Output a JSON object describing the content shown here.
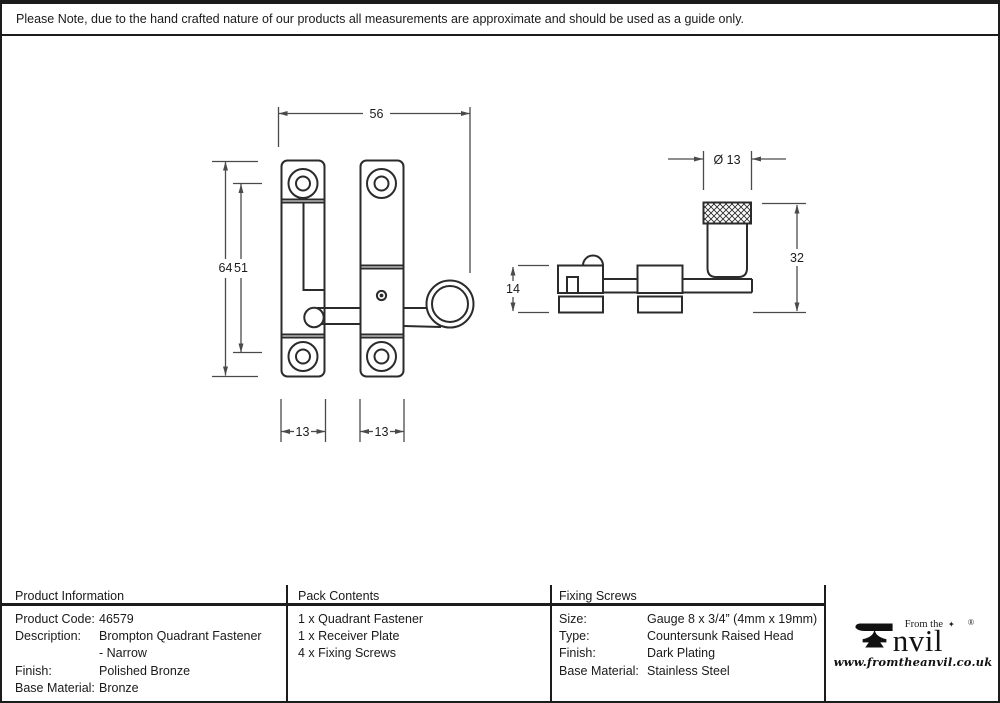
{
  "drawing": {
    "front_view": {
      "dim_width_total": "56",
      "dim_height_outer": "64",
      "dim_height_inner": "51",
      "dim_plate_width_left": "13",
      "dim_plate_width_right": "13"
    },
    "side_view": {
      "dim_diameter": "Ø 13",
      "dim_overall_height": "32",
      "dim_plate_height": "14"
    }
  },
  "note": "Please Note, due to the hand crafted nature of our products all measurements are approximate and should be used as a guide only.",
  "table": {
    "product_information": {
      "header": "Product Information",
      "rows": [
        {
          "label": "Product Code:",
          "value": "46579"
        },
        {
          "label": "Description:",
          "value": "Brompton Quadrant Fastener"
        },
        {
          "label": "",
          "value": "- Narrow"
        },
        {
          "label": "Finish:",
          "value": "Polished Bronze"
        },
        {
          "label": "Base Material:",
          "value": "Bronze"
        }
      ]
    },
    "pack_contents": {
      "header": "Pack Contents",
      "items": [
        "1 x Quadrant Fastener",
        "1 x Receiver Plate",
        "4 x Fixing Screws"
      ]
    },
    "fixing_screws": {
      "header": "Fixing Screws",
      "rows": [
        {
          "label": "Size:",
          "value": "Gauge 8 x 3/4” (4mm x 19mm)"
        },
        {
          "label": "Type:",
          "value": "Countersunk Raised Head"
        },
        {
          "label": "Finish:",
          "value": "Dark Plating"
        },
        {
          "label": "Base Material:",
          "value": "Stainless Steel"
        }
      ]
    }
  },
  "logo": {
    "tagline": "From the",
    "star": "✦",
    "registered": "®",
    "brand": "nvil",
    "url": "www.fromtheanvil.co.uk"
  },
  "colors": {
    "line": "#2b2b2b",
    "dimension": "#4a4a4a",
    "text": "#1a1a1a",
    "background": "#ffffff"
  }
}
